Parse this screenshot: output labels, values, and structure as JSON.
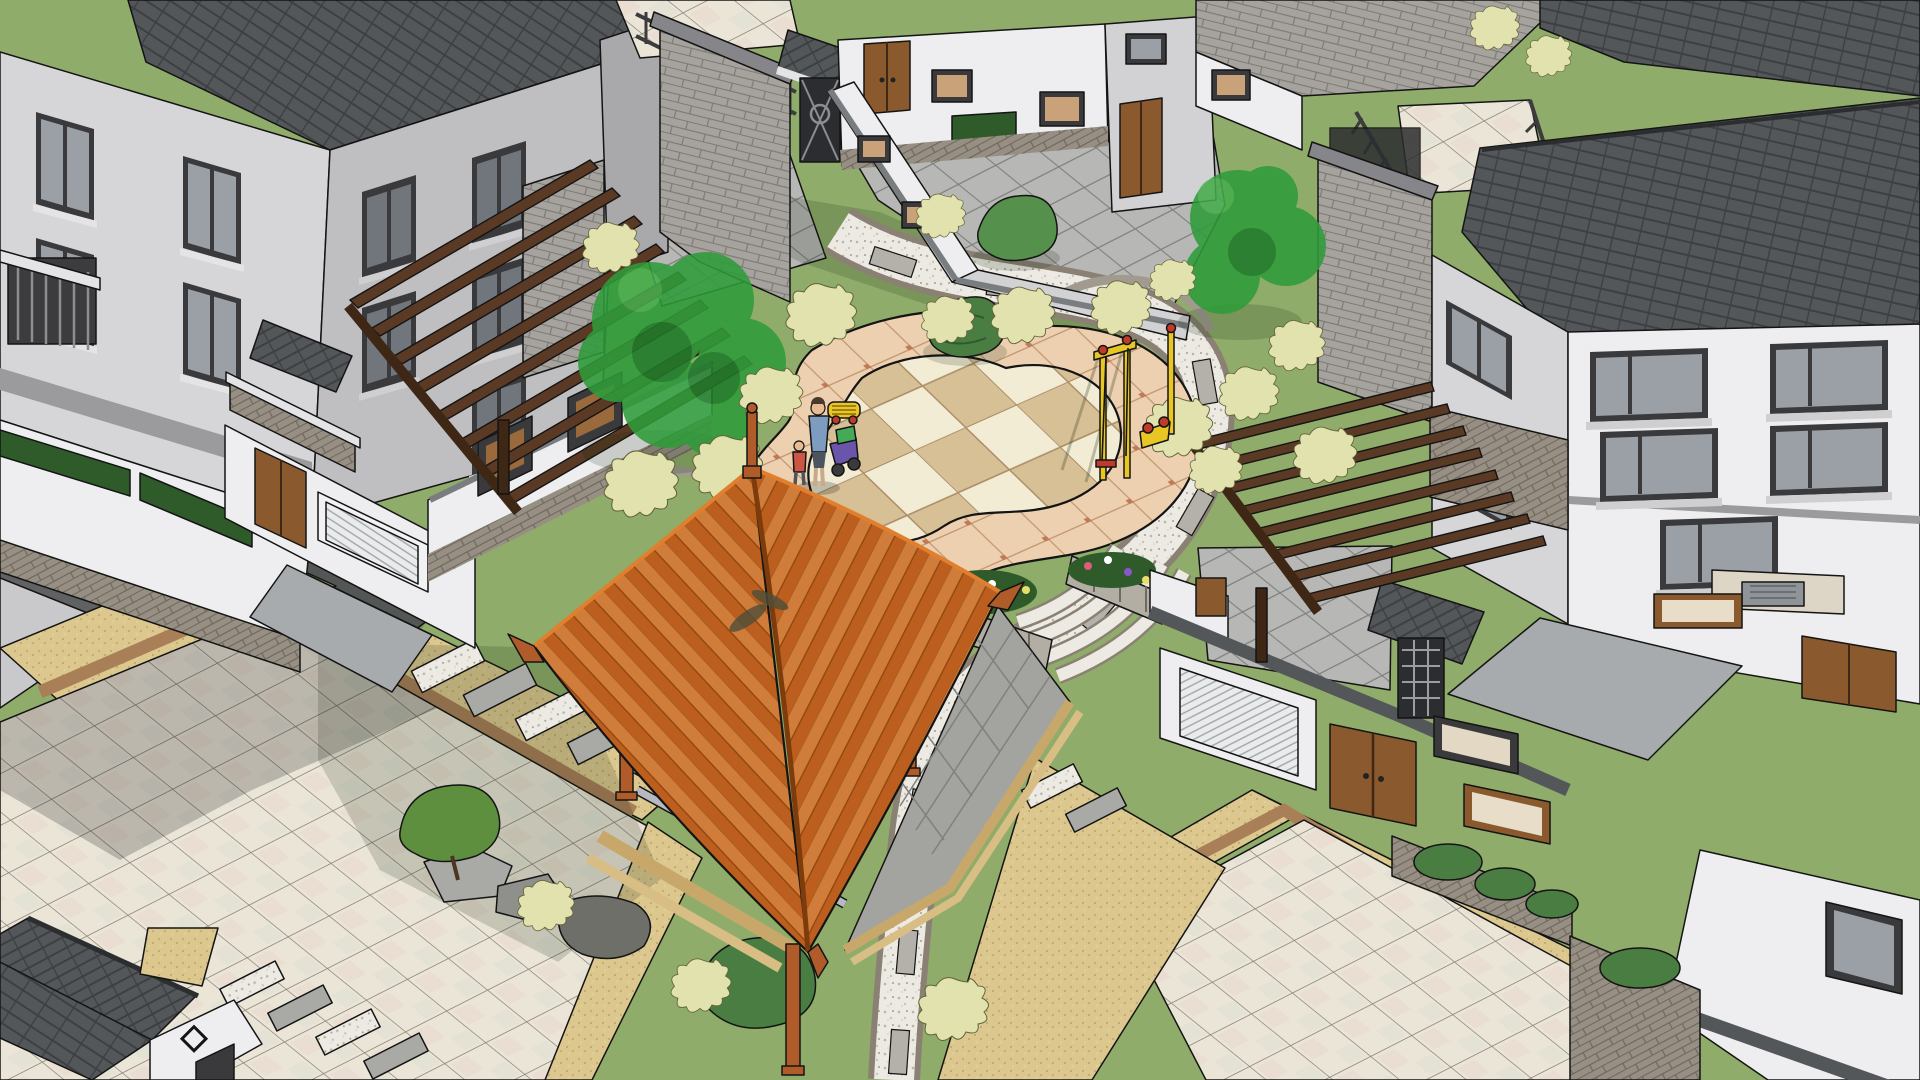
{
  "meta": {
    "title": "Aerial 3D model view of a residential courtyard garden",
    "render_style": "sketchup shaded with black edge lines",
    "view": "bird's-eye isometric"
  },
  "palette": {
    "line": "#141414",
    "wallLit": "#d6d6d8",
    "wallMid": "#bfbfc1",
    "wallShade": "#a9a9ab",
    "wallDark": "#8e8e91",
    "whiteLit": "#eeeef0",
    "whiteShade": "#d2d2d5",
    "roofDark": "#54575a",
    "roofDarker": "#3d4043",
    "roofFascia": "#caccce",
    "brick": "#a6a39e",
    "brickLine": "#7e7b76",
    "stoneBase": "#978f83",
    "lawn": "#8fac6a",
    "lawnShade": "#74914f",
    "bushPale": "#e2e2ae",
    "bushPaleLine": "#62623a",
    "treeGreen": "#2f9c3a",
    "treeDark": "#1f7a2a",
    "shrub": "#4a7d42",
    "shrubDark": "#2f5a2a",
    "plazaBand": "#ecd0b0",
    "plazaLine": "#a4764f",
    "plazaAccent": "#c07a58",
    "checkLight": "#f2ecd4",
    "checkTan": "#d8c096",
    "granite": "#eceae3",
    "graniteBand": "#b4b1aa",
    "pebble": "#8a8174",
    "sand": "#dcc88e",
    "sandDot": "#bfa468",
    "sandBrown": "#a97f58",
    "tileLight": "#ebe5d8",
    "tileLine": "#8b8478",
    "asphalt": "#5f6163",
    "roadGray": "#c9c9cb",
    "pergola": "#5a3a24",
    "pergolaDark": "#3e2715",
    "gazRoof": "#bb5e1e",
    "gazRoofLight": "#d07c3a",
    "gazRoofDark": "#93470f",
    "gazPost": "#b05c2a",
    "wood": "#c8a76a",
    "doorBrown": "#8a5a2e",
    "doorDark": "#5f3c1c",
    "frame": "#3a3a3c",
    "glass": "#9aa0a6",
    "glassDark": "#70767c",
    "playYellow": "#e8c623",
    "playRed": "#c03a2a",
    "flowerPink": "#d95f7a",
    "flowerYellow": "#e6e06a",
    "flowerPurple": "#8a55c8",
    "stonePave": "#b7b7b5",
    "stonePaveLine": "#80807e"
  },
  "scene": {
    "buildings": [
      "three-story gray villa block, top-left, dark tiled roof",
      "gray brick entry tower with roof terrace and railing, top-center",
      "white courtyard walls with lattice windows and wooden double doors",
      "large white villa, right side, dark tiled hip roof, gray brick chimney",
      "garden gatehouse with dark gable roof, bottom-left corner"
    ],
    "landscape": [
      "central kidney-shaped plaza with cream/tan checkerboard paving",
      "pink-tan tile band with rust accents around plaza",
      "winding white granite path with pebble edges and gray cross bands",
      "radial stone steps off plaza south-east edge",
      "lawn with pale clipped shrubs and painterly green trees",
      "stone-walled flower planters",
      "square ceramic-tile patios with sand-colored borders, bottom-left and bottom-right",
      "granite stepping-stone walks",
      "asphalt drive and light gray road, far left"
    ],
    "objects": [
      "timber pavilion (gazebo) with orange hipped roof, upturned eaves and finial",
      "two dark-brown timber pergolas",
      "yellow playground equipment with red seats",
      "adult and child figures with stroller near plaza",
      "ribbed white garage doors",
      "brown timber entry doors"
    ]
  }
}
